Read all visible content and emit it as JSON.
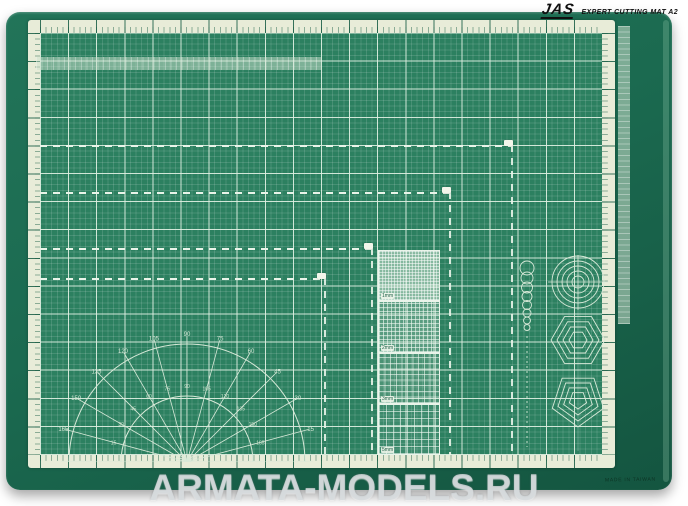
{
  "header": {
    "brand": "JAS",
    "title": "EXPERT CUTTING MAT A2"
  },
  "mat": {
    "made_in": "MADE IN TAIWAN",
    "square_labels": [
      "1mm",
      "2mm",
      "3mm",
      "5mm"
    ],
    "protractor_outer_labels": [
      15,
      30,
      45,
      60,
      75,
      90,
      105,
      120,
      135,
      150,
      165
    ],
    "protractor_inner_labels": [
      165,
      150,
      135,
      120,
      105,
      90,
      75,
      60,
      45,
      30,
      15
    ]
  },
  "watermark": "ARMATA-MODELS.RU",
  "colors": {
    "background": "#ffffff",
    "mat_border_green": "#1b6a50",
    "mat_field_green": "#2c8060",
    "grid_line": "#e0f0e2",
    "ruler_band_cream": "#e8ecd8",
    "ruler_tick_green": "#175c44",
    "dashed_guide": "#e9f4e9",
    "logo_black": "#101010",
    "watermark_gray": "#d6dadd"
  }
}
